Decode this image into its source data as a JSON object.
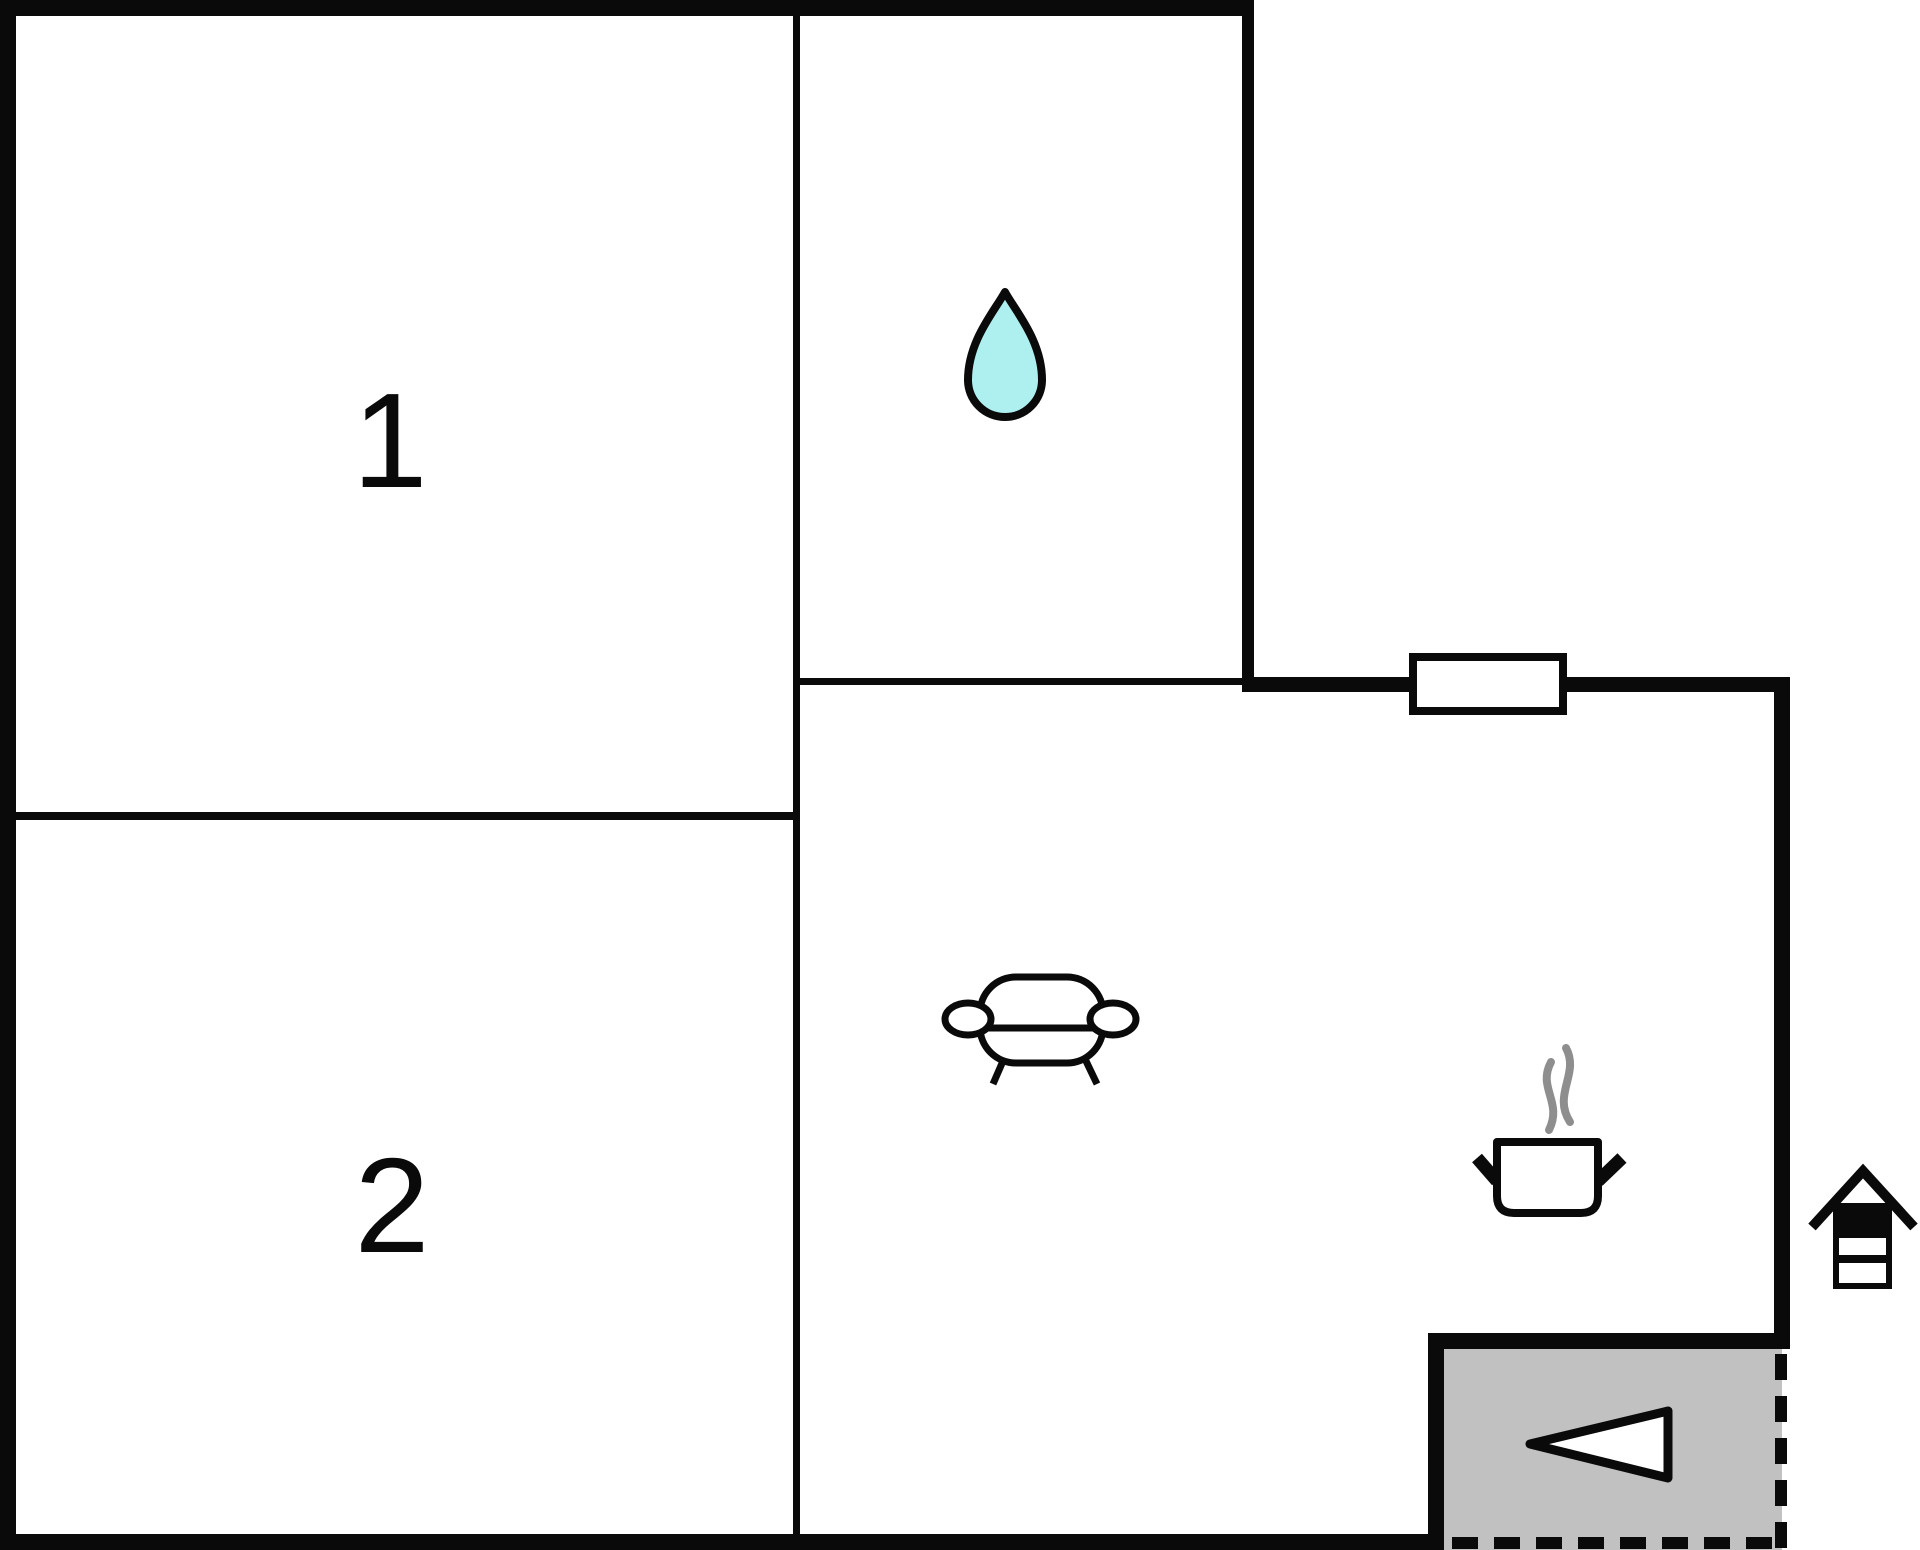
{
  "plan": {
    "rooms": {
      "room1": {
        "label": "1"
      },
      "room2": {
        "label": "2"
      }
    },
    "icons": {
      "bathroom": "water-drop-icon",
      "living_area": "sofa-icon",
      "kitchen": "cooking-pot-icon",
      "entrance": "arrow-left-icon",
      "outside_marker": "house-icon",
      "wall_opening": "window"
    },
    "colors": {
      "wall": "#0a0a0a",
      "floor": "#ffffff",
      "drop_fill": "#aeeff0",
      "entrance_floor": "#c1c1c1",
      "steam": "#8e8e8e"
    }
  }
}
